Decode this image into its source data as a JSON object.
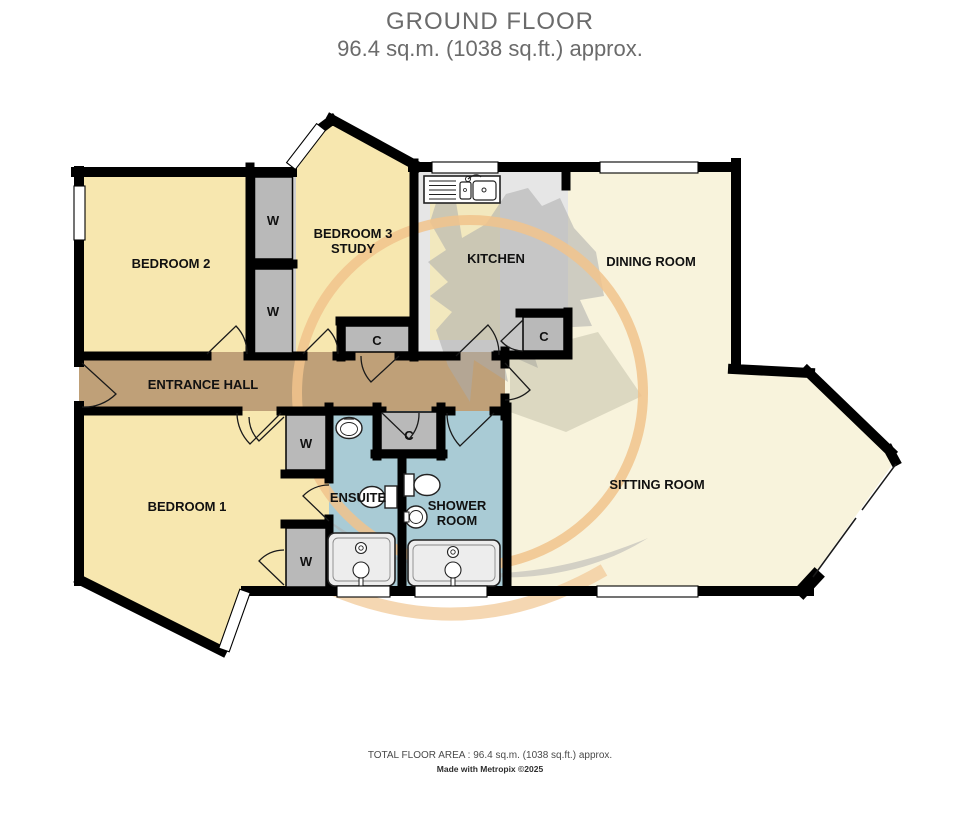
{
  "title": {
    "line1": "GROUND FLOOR",
    "line2": "96.4 sq.m. (1038 sq.ft.) approx."
  },
  "footer": {
    "area": "TOTAL FLOOR AREA : 96.4 sq.m. (1038 sq.ft.) approx.",
    "credit": "Made with Metropix ©2025"
  },
  "rooms": {
    "bedroom2": "BEDROOM 2",
    "bedroom3": {
      "line1": "BEDROOM 3",
      "line2": "STUDY"
    },
    "kitchen": "KITCHEN",
    "dining_room": "DINING ROOM",
    "entrance_hall": "ENTRANCE HALL",
    "bedroom1": "BEDROOM 1",
    "ensuite": "ENSUITE",
    "shower_room": {
      "line1": "SHOWER",
      "line2": "ROOM"
    },
    "sitting_room": "SITTING ROOM"
  },
  "storage": {
    "wardrobe_label": "W",
    "cupboard_label": "C"
  },
  "colors": {
    "room_yellow": "#F7E7AF",
    "room_cream": "#F8F3DC",
    "kitchen_gray": "#E6E6E6",
    "hall_tan": "#BFA078",
    "bath_blue": "#A9CBD5",
    "closet_gray": "#B9B9B9",
    "wall_black": "#000000",
    "watermark_orange": "#F1C38C",
    "watermark_gray": "#ACACAC",
    "title_gray": "#6B6B6B"
  }
}
